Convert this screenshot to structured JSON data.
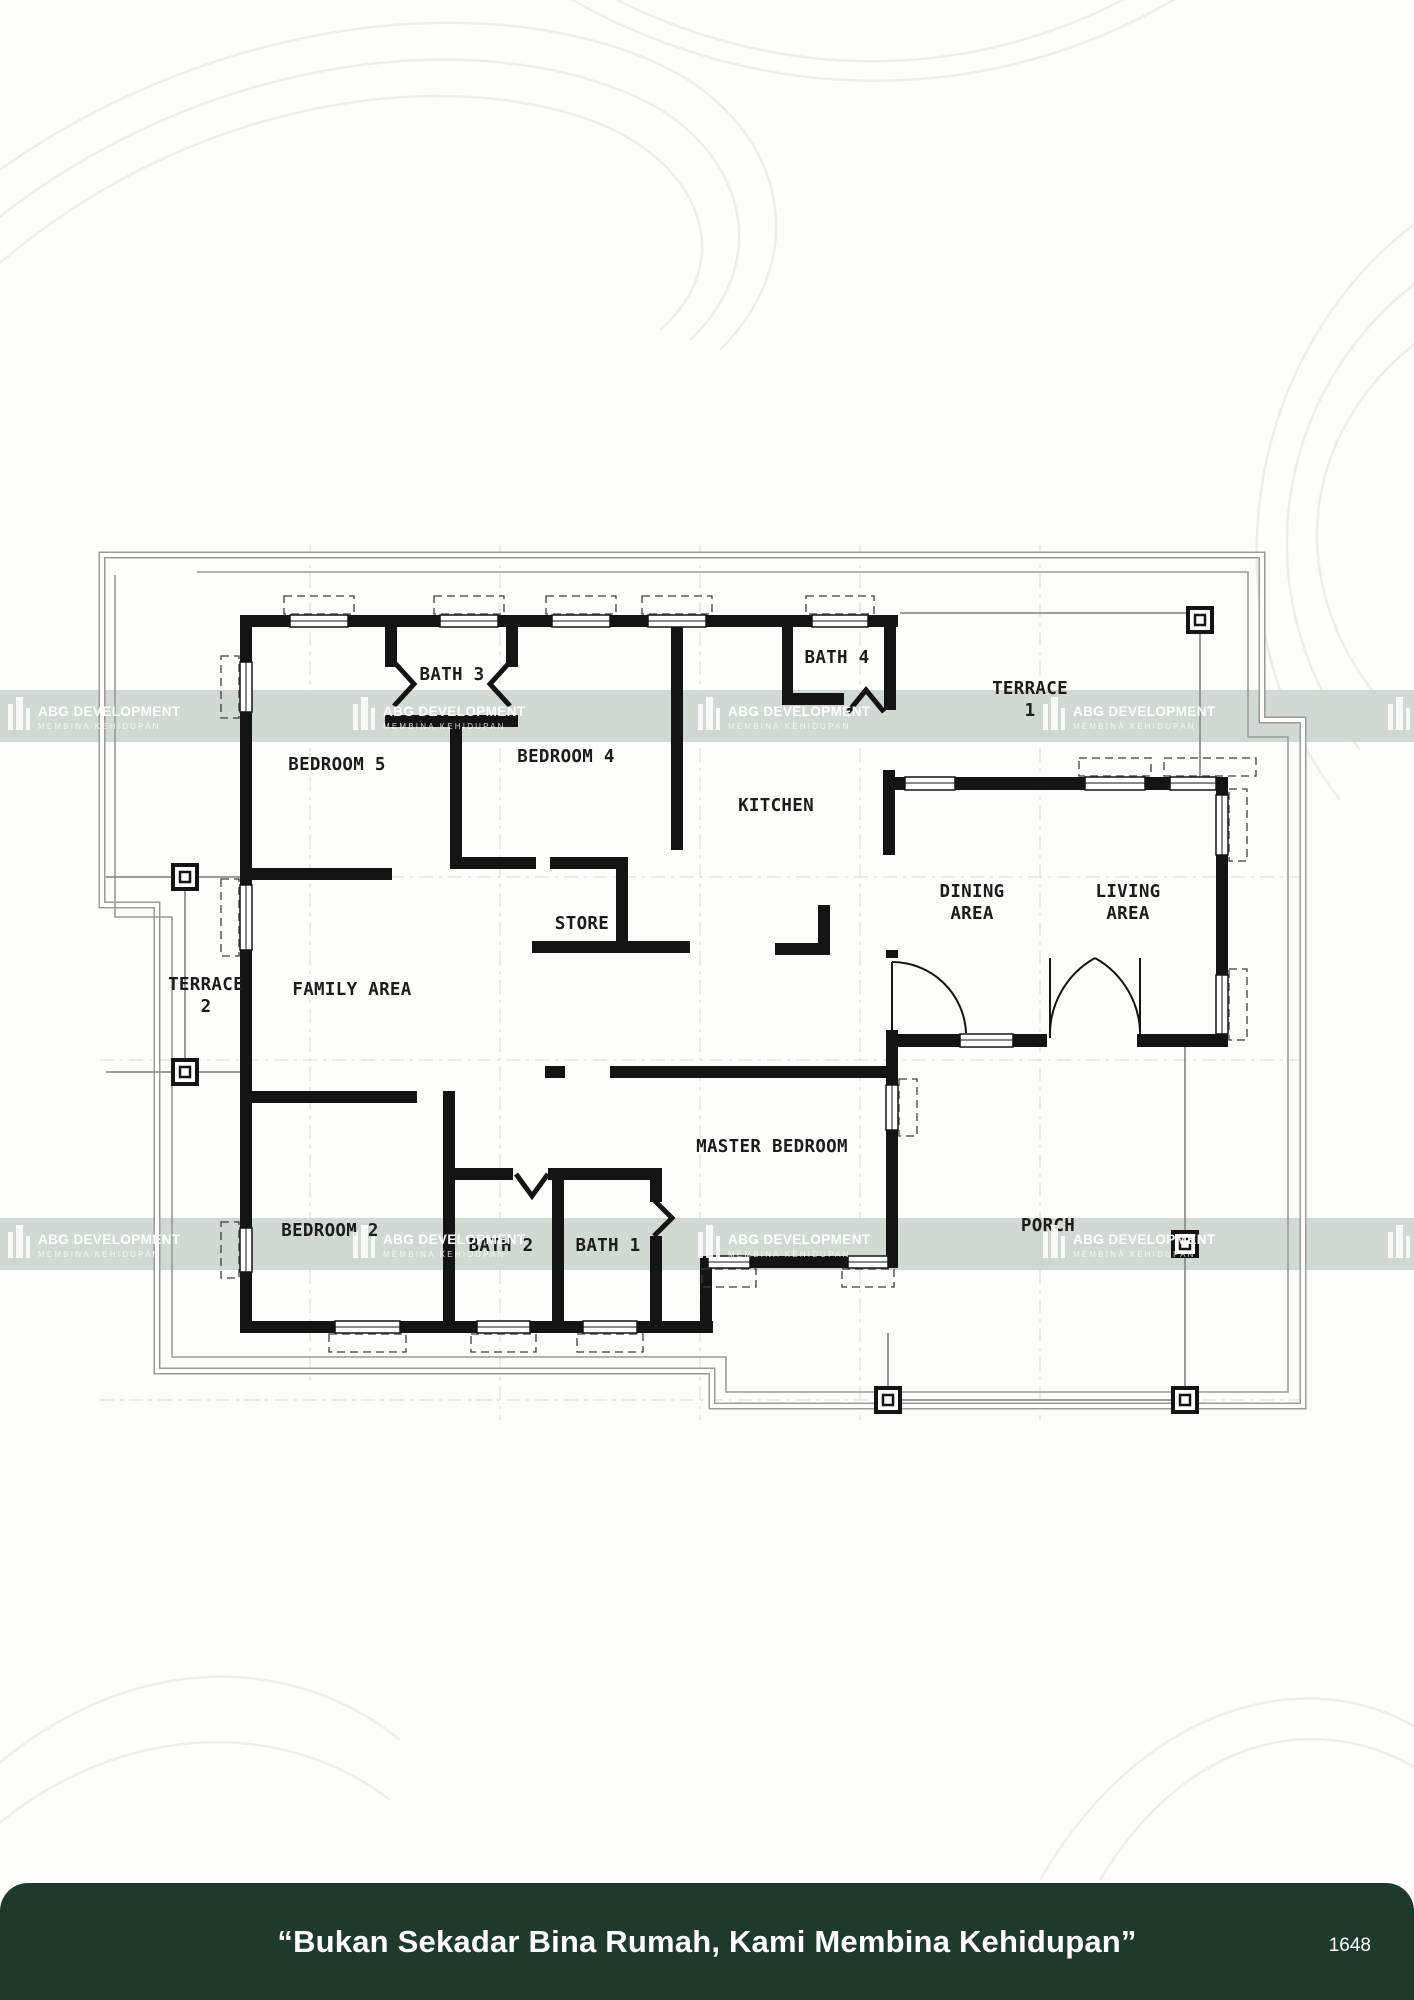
{
  "watermark": {
    "title": "ABG DEVELOPMENT",
    "subtitle": "MEMBINA KEHIDUPAN"
  },
  "footer": {
    "quote": "“Bukan Sekadar Bina Rumah, Kami Membina Kehidupan”",
    "code": "1648",
    "bg": "#1d3a2b",
    "text_color": "#ffffff"
  },
  "colors": {
    "band": "#cdd6d0",
    "wall": "#141414",
    "boundary": "#8c8c8c",
    "beam": "#8f8f8f",
    "label": "#1c1c1c",
    "contour": "#ededeb"
  },
  "rooms": [
    {
      "id": "bath-3",
      "line1": "BATH 3",
      "line2": ""
    },
    {
      "id": "bath-4",
      "line1": "BATH 4",
      "line2": ""
    },
    {
      "id": "terrace-1",
      "line1": "TERRACE",
      "line2": "1"
    },
    {
      "id": "bedroom-5",
      "line1": "BEDROOM 5",
      "line2": ""
    },
    {
      "id": "bedroom-4",
      "line1": "BEDROOM 4",
      "line2": ""
    },
    {
      "id": "kitchen",
      "line1": "KITCHEN",
      "line2": ""
    },
    {
      "id": "store",
      "line1": "STORE",
      "line2": ""
    },
    {
      "id": "dining-area",
      "line1": "DINING",
      "line2": "AREA"
    },
    {
      "id": "living-area",
      "line1": "LIVING",
      "line2": "AREA"
    },
    {
      "id": "terrace-2",
      "line1": "TERRACE",
      "line2": "2"
    },
    {
      "id": "family-area",
      "line1": "FAMILY AREA",
      "line2": ""
    },
    {
      "id": "master-bedroom",
      "line1": "MASTER BEDROOM",
      "line2": ""
    },
    {
      "id": "bedroom-2",
      "line1": "BEDROOM 2",
      "line2": ""
    },
    {
      "id": "bath-2",
      "line1": "BATH 2",
      "line2": ""
    },
    {
      "id": "bath-1",
      "line1": "BATH 1",
      "line2": ""
    },
    {
      "id": "porch",
      "line1": "PORCH",
      "line2": ""
    }
  ]
}
